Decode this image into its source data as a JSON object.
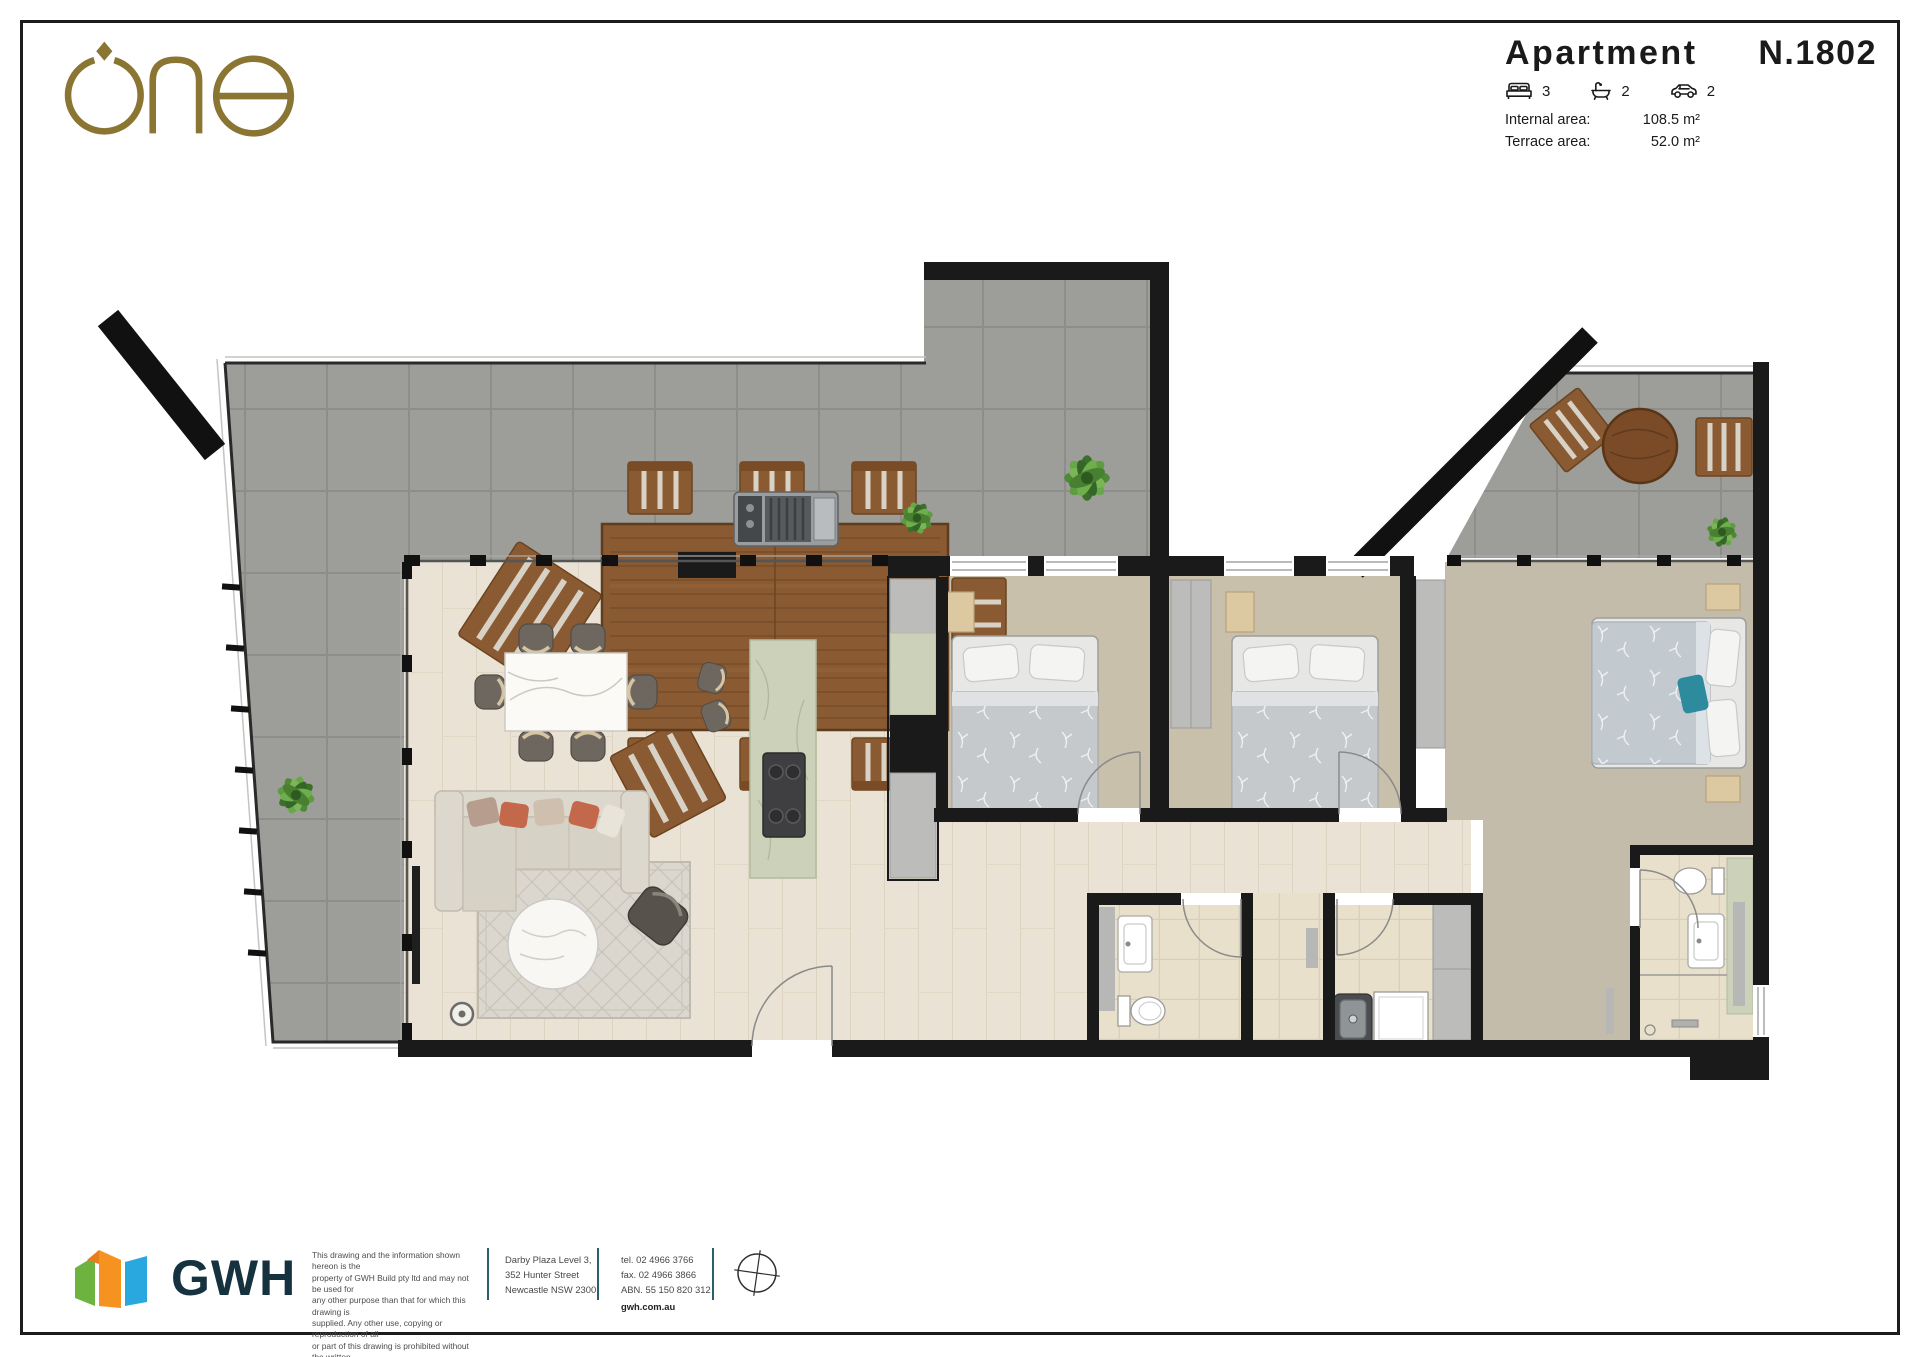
{
  "brand": {
    "logo_text": "one",
    "logo_color": "#8b7533"
  },
  "title_block": {
    "label": "Apartment",
    "number": "N.1802",
    "beds": "3",
    "baths": "2",
    "cars": "2",
    "internal_area_label": "Internal area:",
    "internal_area_value": "108.5 m²",
    "terrace_area_label": "Terrace area:",
    "terrace_area_value": "52.0 m²"
  },
  "palette": {
    "wall": "#1a1a1a",
    "terrace_tile": "#9d9d99",
    "timber_floor": "#eae3d5",
    "bedroom_carpet": "#c8c0ab",
    "wet_area_tile": "#e8e0cb",
    "island_marble": "#ccd1ba",
    "outdoor_timber": "#8a5a33",
    "accent_teal": "#2e8b9e",
    "accent_terracotta": "#c4684b",
    "gwh_navy": "#16323e",
    "gwh_green": "#6cb33f",
    "gwh_orange": "#f69220",
    "gwh_blue": "#29a8df",
    "divider_teal": "#2a6168"
  },
  "footer": {
    "gwh_logo_text": "GWH",
    "disclaimer_lines": [
      "This drawing and the information shown hereon is the",
      "property of GWH Build pty ltd and may not be used for",
      "any other purpose than that for which this drawing is",
      "supplied. Any other use, copying or reproduction of all",
      "or part of this drawing is prohibited without the written"
    ],
    "disclaimer_last_line": "consent of GWH Build pty ltd.",
    "date_ref": "2023/06/16 [02]",
    "address_lines": [
      "Darby Plaza Level 3,",
      "352 Hunter Street",
      "Newcastle NSW 2300"
    ],
    "contact_lines": [
      "tel. 02 4966 3766",
      "fax. 02 4966 3866",
      "ABN. 55 150 820 312"
    ],
    "website": "gwh.com.au"
  }
}
